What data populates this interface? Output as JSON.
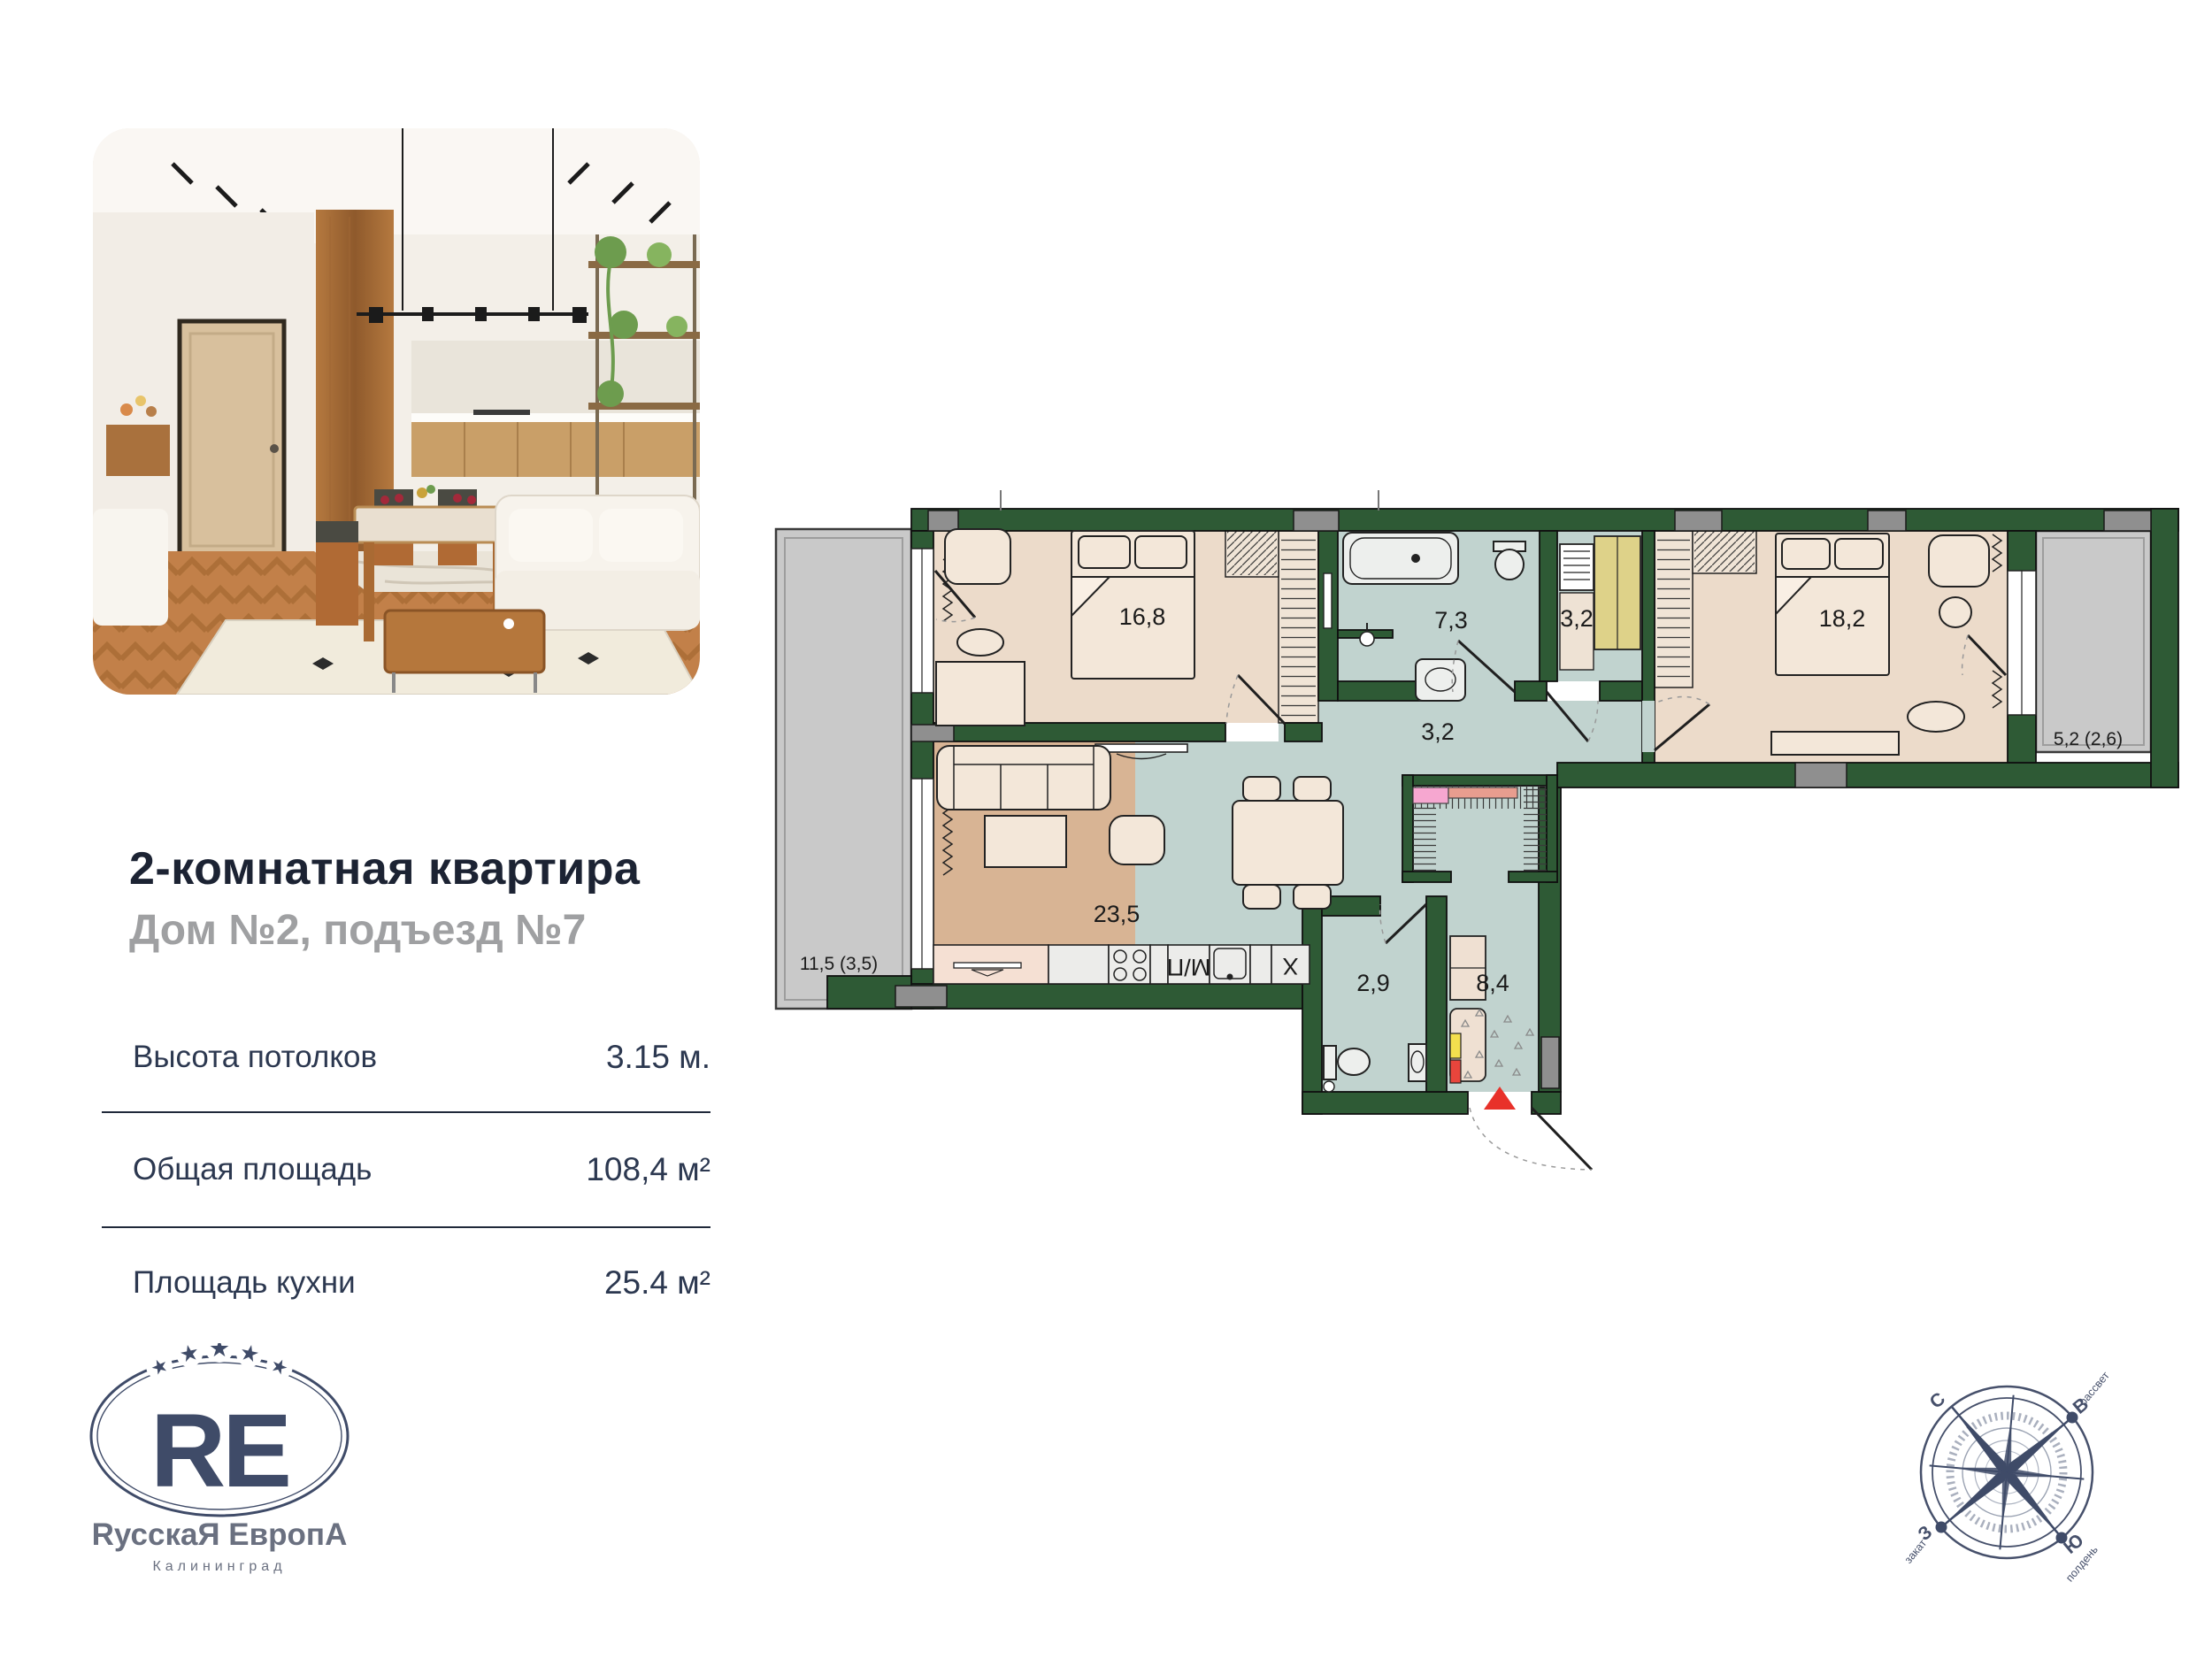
{
  "listing": {
    "title": "2-комнатная квартира",
    "subtitle": "Дом №2, подъезд №7",
    "specs": [
      {
        "label": "Высота потолков",
        "value": "3.15 м."
      },
      {
        "label": "Общая площадь",
        "value": "108,4 м²"
      },
      {
        "label": "Площадь кухни",
        "value": "25.4 м²"
      }
    ]
  },
  "logo": {
    "monogram": "RE",
    "brand": "RусскаЯ ЕвропА",
    "city": "Калининград",
    "star": "★"
  },
  "plan": {
    "rooms": [
      {
        "id": "bedroom-1",
        "area": "16,8"
      },
      {
        "id": "bathroom",
        "area": "7,3"
      },
      {
        "id": "storage",
        "area": "3,2"
      },
      {
        "id": "hallway",
        "area": "3,2"
      },
      {
        "id": "bedroom-2",
        "area": "18,2"
      },
      {
        "id": "balcony-right",
        "area": "5,2 (2,6)"
      },
      {
        "id": "living-kitchen",
        "area": "23,5"
      },
      {
        "id": "wc",
        "area": "2,9"
      },
      {
        "id": "entrance-hall",
        "area": "8,4"
      },
      {
        "id": "balcony-left",
        "area": "11,5 (3,5)"
      }
    ],
    "appliance_labels": {
      "washer": "М/П",
      "hood": "X"
    }
  },
  "compass": {
    "n": "С",
    "e": "В",
    "s": "Ю",
    "w": "З",
    "dawn": "рассвет",
    "sunset": "закат",
    "noon": "полдень"
  },
  "colors": {
    "wall_green": "#2e5a35",
    "room_beige": "#ecdbca",
    "room_teal": "#c1d3cf",
    "room_tan": "#d8b494",
    "balcony_gray": "#c9c9c9",
    "entrance_marker_red": "#e8312a",
    "brand_navy": "#3f4b68",
    "title_navy": "#1c2333",
    "subtitle_gray": "#9fa0a2"
  }
}
